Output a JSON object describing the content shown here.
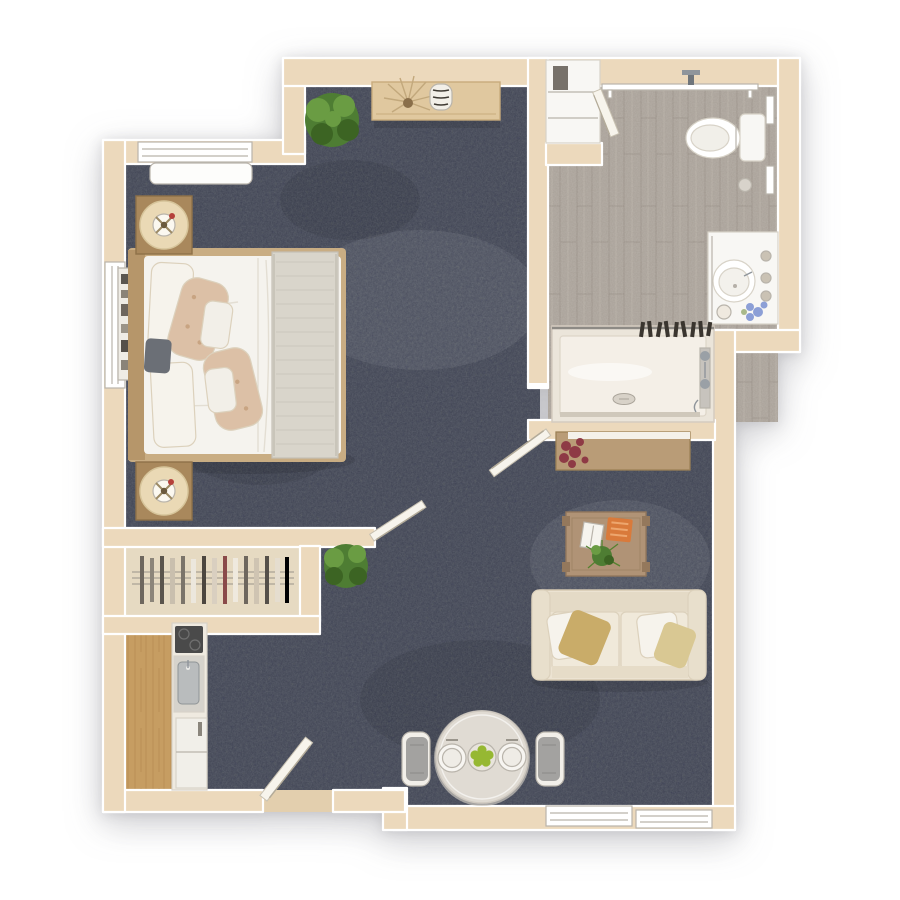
{
  "scene": {
    "type": "3d-floor-plan-top-down",
    "subject": "studio apartment floor plan render",
    "background": "#ffffff",
    "rooms": [
      "bedroom",
      "bathroom",
      "closet",
      "kitchenette",
      "living-dining-area",
      "entry"
    ]
  },
  "palette": {
    "wall": "#ecd9bc",
    "wall_shade": "#dcc3a0",
    "carpet": "#474c56",
    "carpet_light": "#5a606b",
    "bath_floor": "#a8a097",
    "wood_floor": "#c69d62",
    "closet_floor": "#e6dac2",
    "threshold": "#e3cfae",
    "door": "#f7f4ec",
    "white_fixture": "#f8f7f4",
    "shower_pan": "#ebe5da",
    "shower_tray": "#f4efe7",
    "duvet": "#f5f3ee",
    "throw": "#d9d5cb",
    "pillow_patterned": "#dcc0a6",
    "pillow_white": "#f6f3ec",
    "pillow_gold": "#c9ac69",
    "pillow_gold_light": "#d9c893",
    "dark_cushion": "#6b6f76",
    "sofa": "#ece3d2",
    "sofa_back": "#e4dac6",
    "seat_cushion": "#f0e9da",
    "wood_nightstand": "#a9885c",
    "wood_headboard": "#b6966a",
    "wood_bedframe": "#c9ad83",
    "wood_console": "#e0c89f",
    "wood_sideboard": "#b99c77",
    "wood_coffee_table": "#b09376",
    "table_top": "#e0dbd3",
    "chair_gray": "#a3a2a0",
    "chair_frame": "#f2efe9",
    "plate": "#f7f5f1",
    "plant_green": "#4e7d33",
    "plant_green_light": "#6a9c43",
    "plant_green_dark": "#3c6423",
    "flower_red": "#8e3a45",
    "flower_blue": "#8c9fd6",
    "accent_orange": "#d97a3b",
    "notebook": "#f6f4ee",
    "chrome": "#9aa0a6",
    "lamp_shade": "#ead9b5",
    "lamp_center": "#6b5a3e",
    "lamp_accent_red": "#b5403a",
    "apple_green": "#96b832",
    "cooktop": "#4a4a4a",
    "sink_steel": "#b9bcbd",
    "fridge": "#f1efe9",
    "hanger_dark": "#3a352f"
  },
  "furniture": {
    "bedroom": [
      "queen-bed",
      "nightstand-with-lamp x2",
      "console-table",
      "potted-plant",
      "wall-shelf",
      "hvac-unit"
    ],
    "bathroom": [
      "toilet",
      "vanity-sink",
      "roll-in-shower",
      "grab-bars",
      "towel-rail",
      "linen-cabinet"
    ],
    "closet": [
      "hanging-rod-with-clothes"
    ],
    "kitchenette": [
      "cooktop",
      "sink",
      "refrigerator"
    ],
    "living": [
      "loveseat-sofa",
      "coffee-table",
      "sideboard",
      "round-dining-table",
      "dining-chair x2",
      "potted-plant"
    ]
  },
  "openings": {
    "doors": [
      "entry-door",
      "closet-door",
      "bathroom-door-upper",
      "bathroom-door-lower"
    ],
    "windows": [
      "bedroom-top-window",
      "bedroom-left-window",
      "living-bottom-window-1",
      "living-bottom-window-2"
    ]
  }
}
